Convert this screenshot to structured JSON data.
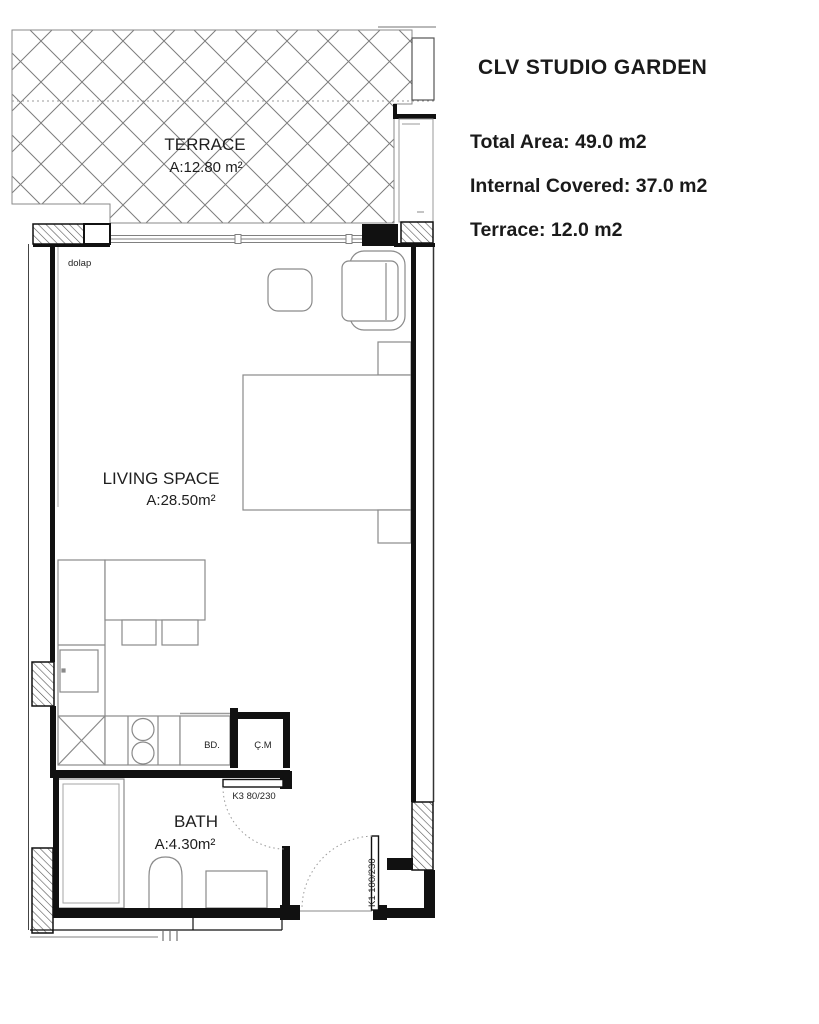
{
  "header": {
    "title": "CLV STUDIO GARDEN",
    "total_area": "Total Area: 49.0 m2",
    "internal_covered": "Internal Covered: 37.0 m2",
    "terrace_line": "Terrace: 12.0 m2"
  },
  "plan": {
    "terrace": {
      "name": "TERRACE",
      "area": "A:12.80 m²"
    },
    "living": {
      "name": "LIVING SPACE",
      "area": "A:28.50m²"
    },
    "bath": {
      "name": "BATH",
      "area": "A:4.30m²"
    },
    "labels": {
      "closet": "dolap",
      "counter_unit": "BD.",
      "washing_machine": "Ç.M",
      "bath_door": "K3 80/230",
      "entry_door": "K1 100/230"
    },
    "colors": {
      "wall": "#111111",
      "furniture_line": "#8a8a8a",
      "hatch_line": "#555555",
      "lattice_line": "#7d7d7d"
    }
  }
}
